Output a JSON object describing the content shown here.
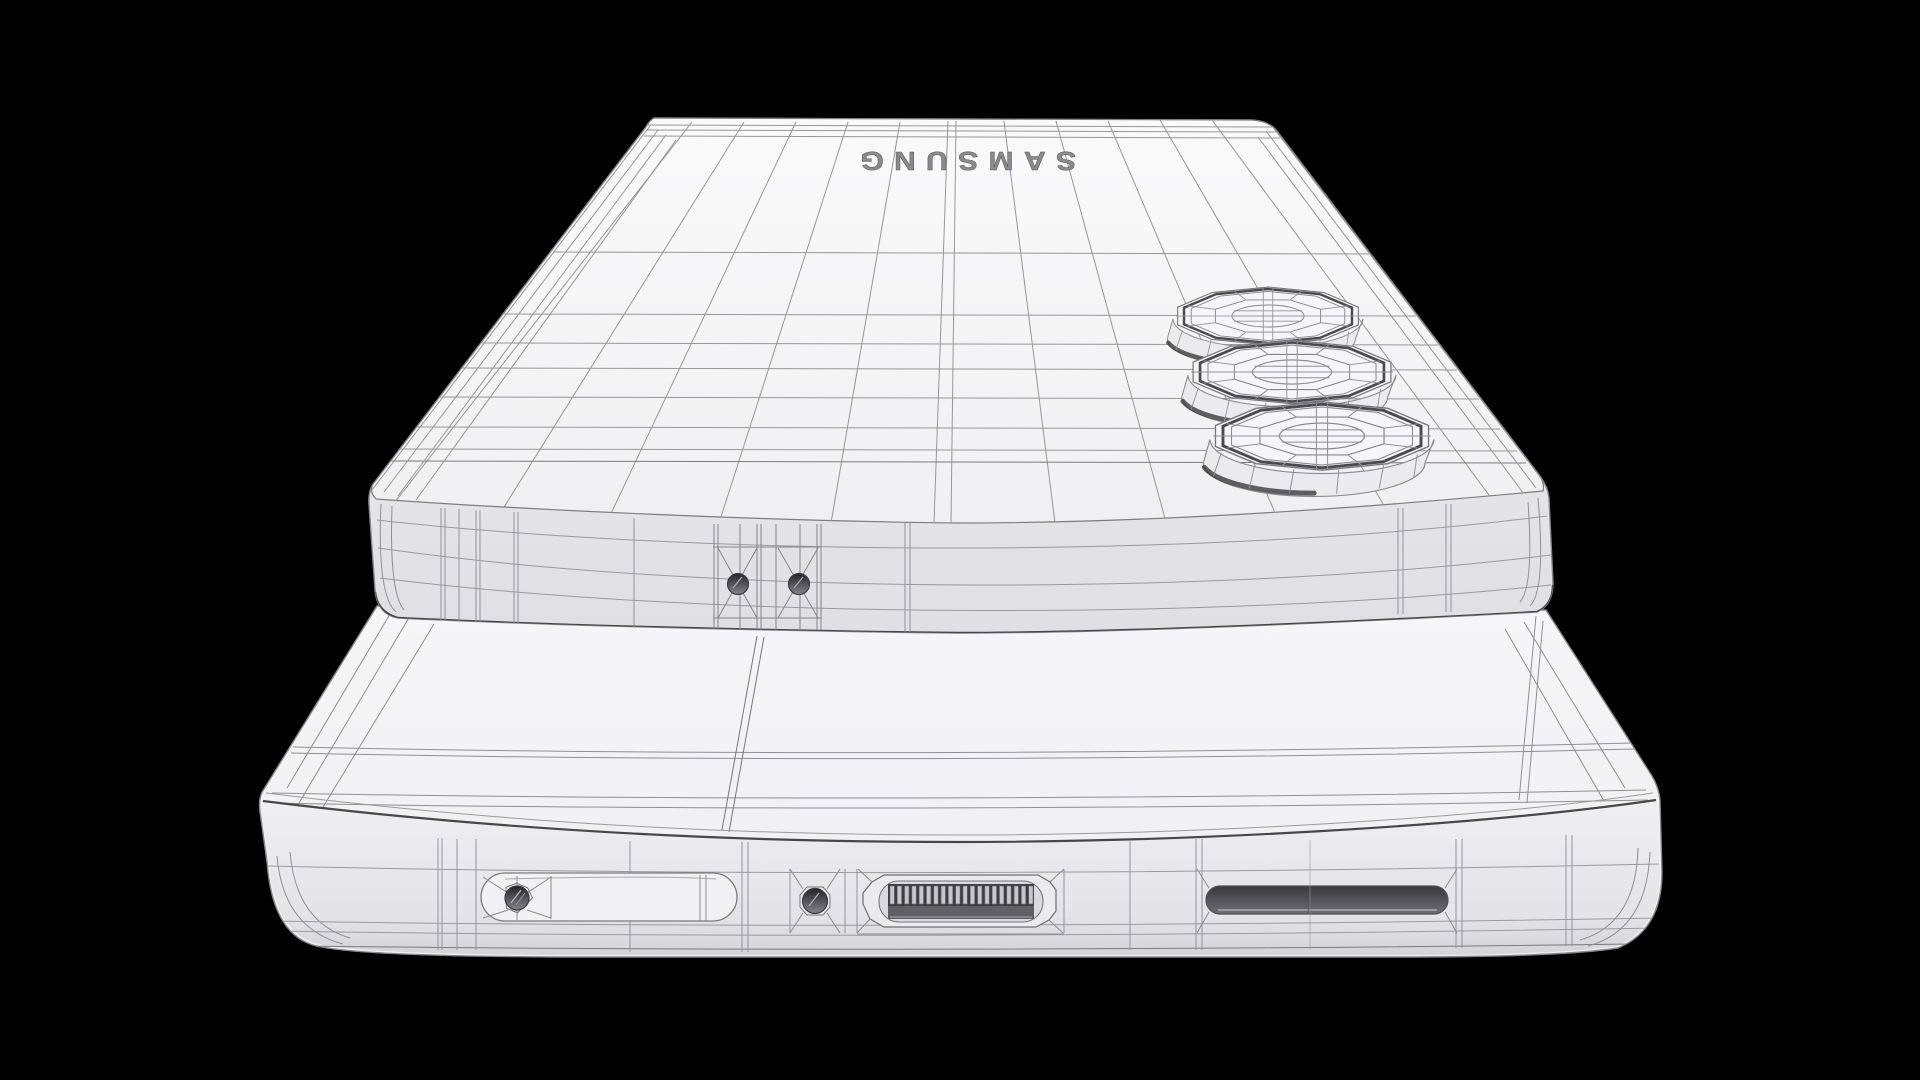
{
  "scene": {
    "brand_text": "SAMSUNG",
    "brand_text_orientation": "rotated-180",
    "background_color": "#000000",
    "colors": {
      "body": "#f3f3f5",
      "band": "#e9e9eb",
      "wireframe_light": "#9b9b9f",
      "wireframe_mid": "#7b7b7f",
      "wireframe_dark": "#454548",
      "port_dark": "#3e3e41",
      "speaker_dark": "#39393c"
    },
    "objects": [
      "top-phone-back-wireframe",
      "camera-lens-1",
      "camera-lens-2",
      "camera-lens-3",
      "top-phone-mic-holes",
      "bottom-phone-edge-wireframe",
      "sim-tray",
      "sim-eject-hole",
      "microphone-hole",
      "usb-c-port",
      "speaker-grille"
    ]
  }
}
